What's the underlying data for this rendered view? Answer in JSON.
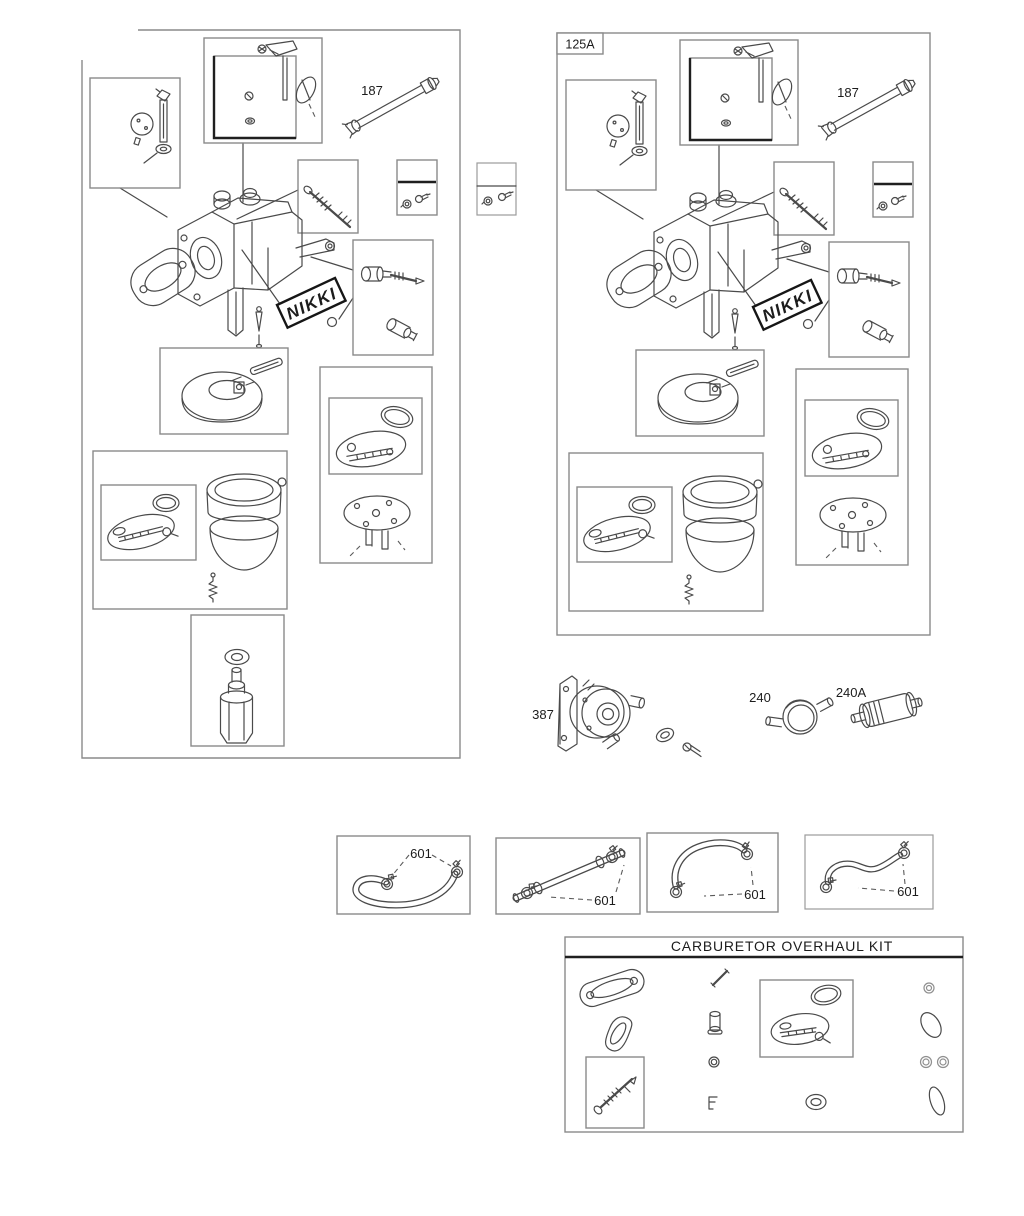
{
  "page": {
    "background": "#ffffff",
    "line_color": "#4a4a4a",
    "box_border_color": "#8a8a8a",
    "accent_color": "#1a1a1a"
  },
  "left_assembly": {
    "fuel_pipe_label": "187",
    "brand_plate": "NIKKI"
  },
  "right_assembly": {
    "panel_tag": "125A",
    "fuel_pipe_label": "187",
    "brand_plate": "NIKKI"
  },
  "loose_parts": {
    "fuel_pump": "387",
    "inline_filter": "240",
    "canister_filter": "240A"
  },
  "hose_kits": [
    {
      "label": "601"
    },
    {
      "label": "601"
    },
    {
      "label": "601"
    },
    {
      "label": "601"
    }
  ],
  "overhaul_kit": {
    "title": "CARBURETOR OVERHAUL KIT"
  }
}
